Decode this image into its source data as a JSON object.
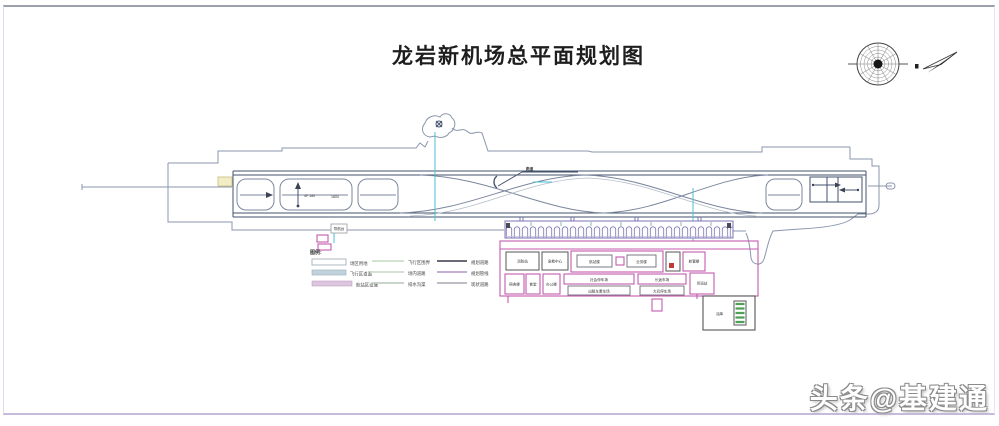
{
  "title": "龙岩新机场总平面规划图",
  "watermark": "头条@基建通",
  "legend": {
    "header": "图例:",
    "col1": [
      {
        "label": "场区用地",
        "swatch": "#ffffff"
      },
      {
        "label": "飞行区道面",
        "swatch": "#c2d2dc"
      },
      {
        "label": "航站区设施",
        "swatch": "#dcc6de"
      }
    ],
    "col2": [
      {
        "label": "飞行区围界",
        "color": "#c5d8c2"
      },
      {
        "label": "场内道路",
        "color": "#c5d8c2"
      },
      {
        "label": "排水沟渠",
        "color": "#b9c7b9"
      }
    ],
    "col3": [
      {
        "label": "规划道路",
        "color": "#3a3a4a"
      },
      {
        "label": "规划管线",
        "color": "#b494c4"
      },
      {
        "label": "现状道路",
        "color": "#a8a8b4"
      }
    ]
  },
  "plan": {
    "runway_callout": "跑道",
    "dim_vertical": "4F 180",
    "dim_note": "1800",
    "navaid_label": "导航台",
    "buildings": {
      "b1": "消防站",
      "b2": "急救中心",
      "terminal": "航站楼",
      "b3": "业务楼",
      "b4": "航管楼",
      "r1": "宿舍楼",
      "r2": "食堂",
      "r3": "办公楼",
      "lot1": "社会停车场",
      "lot1_sub": "出租车蓄车场",
      "lot2": "长途车场",
      "lot2_sub": "大巴停车场",
      "cargo": "货运站",
      "fuel": "油库"
    }
  }
}
